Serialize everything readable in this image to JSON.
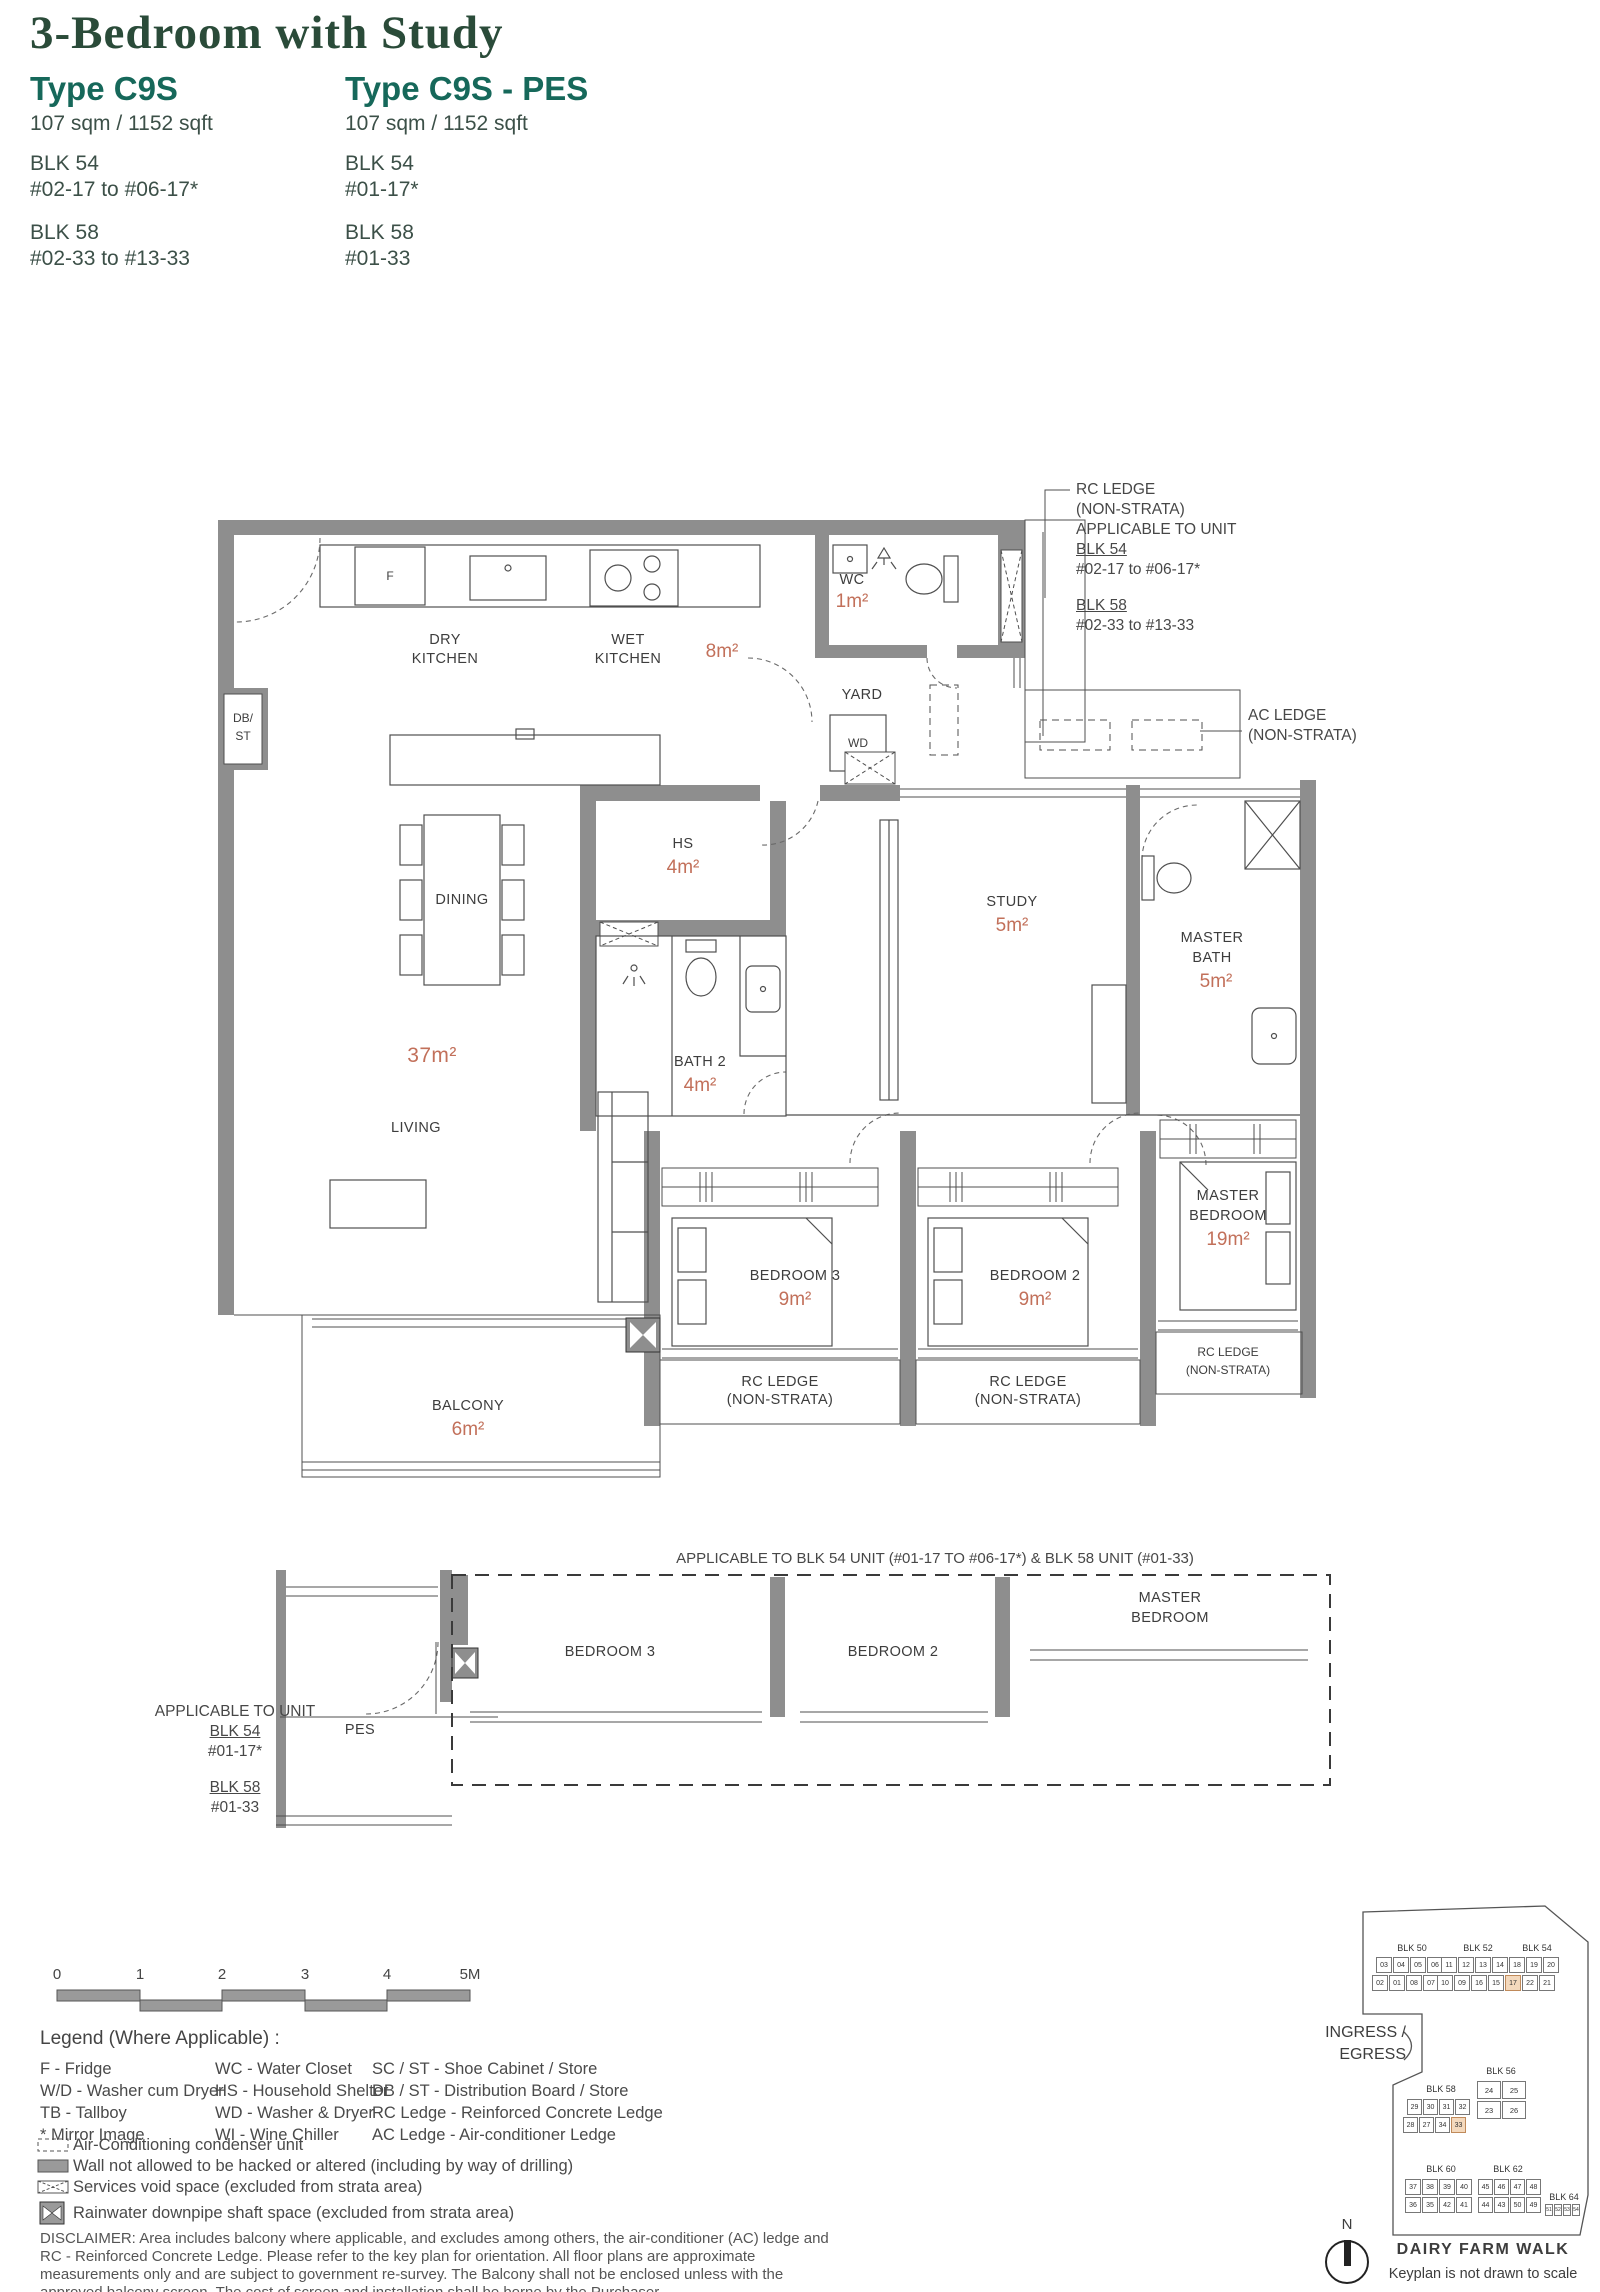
{
  "header": {
    "title": "3-Bedroom with Study",
    "types": [
      {
        "name": "Type C9S",
        "area": "107 sqm / 1152 sqft",
        "blocks": [
          {
            "blk": "BLK 54",
            "units": "#02-17 to #06-17*"
          },
          {
            "blk": "BLK 58",
            "units": "#02-33 to #13-33"
          }
        ]
      },
      {
        "name": "Type C9S - PES",
        "area": "107 sqm / 1152 sqft",
        "blocks": [
          {
            "blk": "BLK 54",
            "units": "#01-17*"
          },
          {
            "blk": "BLK 58",
            "units": "#01-33"
          }
        ]
      }
    ]
  },
  "rooms": {
    "dry": {
      "l1": "DRY",
      "l2": "KITCHEN"
    },
    "wet": {
      "l1": "WET",
      "l2": "KITCHEN",
      "area": "8m²"
    },
    "wc": {
      "l1": "WC",
      "area": "1m²"
    },
    "yard": {
      "l1": "YARD"
    },
    "wd": {
      "l1": "WD"
    },
    "fridge": {
      "l1": "F"
    },
    "dbst": {
      "l1": "DB/",
      "l2": "ST"
    },
    "dining": {
      "l1": "DINING"
    },
    "hs": {
      "l1": "HS",
      "area": "4m²"
    },
    "bath2": {
      "l1": "BATH 2",
      "area": "4m²"
    },
    "study": {
      "l1": "STUDY",
      "area": "5m²"
    },
    "master_bath": {
      "l1": "MASTER",
      "l2": "BATH",
      "area": "5m²"
    },
    "living": {
      "l1": "LIVING",
      "area": "37m²"
    },
    "bedroom3": {
      "l1": "BEDROOM 3",
      "area": "9m²"
    },
    "bedroom2": {
      "l1": "BEDROOM 2",
      "area": "9m²"
    },
    "master_bedroom": {
      "l1": "MASTER",
      "l2": "BEDROOM",
      "area": "19m²"
    },
    "balcony": {
      "l1": "BALCONY",
      "area": "6m²"
    },
    "pes": {
      "l1": "PES"
    }
  },
  "annotations": {
    "rc_top": {
      "l1": "RC LEDGE",
      "l2": "(NON-STRATA)",
      "l3": "APPLICABLE TO UNIT",
      "blk1": "BLK 54",
      "u1": "#02-17 to #06-17*",
      "blk2": "BLK 58",
      "u2": "#02-33 to #13-33"
    },
    "ac": {
      "l1": "AC LEDGE",
      "l2": "(NON-STRATA)"
    },
    "rc": {
      "l1": "RC LEDGE",
      "l2": "(NON-STRATA)"
    },
    "pes_note": {
      "l1": "APPLICABLE TO UNIT",
      "blk1": "BLK 54",
      "u1": "#01-17*",
      "blk2": "BLK 58",
      "u2": "#01-33"
    },
    "ground_note": "APPLICABLE TO BLK 54 UNIT (#01-17 TO #06-17*) & BLK 58 UNIT (#01-33)",
    "ground": {
      "bedroom3": "BEDROOM 3",
      "bedroom2": "BEDROOM 2",
      "master1": "MASTER",
      "master2": "BEDROOM"
    }
  },
  "scalebar": {
    "ticks": [
      "0",
      "1",
      "2",
      "3",
      "4",
      "5M"
    ]
  },
  "legend": {
    "title": "Legend (Where Applicable) :",
    "col1": [
      "F - Fridge",
      "W/D - Washer cum Dryer",
      "TB - Tallboy",
      "* Mirror Image"
    ],
    "col2": [
      "WC - Water Closet",
      "HS - Household Shelter",
      "WD - Washer & Dryer",
      "WI  - Wine Chiller"
    ],
    "col3": [
      "SC / ST - Shoe Cabinet / Store",
      "DB / ST - Distribution Board / Store",
      "RC Ledge - Reinforced Concrete Ledge",
      "AC Ledge - Air-conditioner Ledge"
    ],
    "symbols": [
      "Air-Conditioning condenser unit",
      "Wall not allowed to be hacked or altered (including by way of drilling)",
      "Services void space (excluded from strata area)",
      "Rainwater downpipe shaft space (excluded from strata area)"
    ]
  },
  "disclaimer": "DISCLAIMER: Area includes balcony where applicable, and excludes among others, the air-conditioner (AC) ledge and RC - Reinforced Concrete Ledge. Please refer to the key plan for orientation. All floor plans are approximate measurements only and are subject to government re-survey. The Balcony shall not be enclosed unless with the approved balcony screen. The cost of screen and installation shall be borne by the Purchaser.",
  "keyplan": {
    "blocks": [
      {
        "id": "blk50",
        "name": "BLK 50",
        "row1": [
          "03",
          "04",
          "05",
          "06"
        ],
        "row2": [
          "02",
          "01",
          "08",
          "07"
        ],
        "highlight": []
      },
      {
        "id": "blk52",
        "name": "BLK 52",
        "row1": [
          "11",
          "12",
          "13",
          "14"
        ],
        "row2": [
          "10",
          "09",
          "16",
          "15"
        ],
        "highlight": []
      },
      {
        "id": "blk54",
        "name": "BLK 54",
        "row1": [
          "18",
          "19",
          "20"
        ],
        "row2": [
          "17",
          "22",
          "21"
        ],
        "highlight": [
          "17"
        ]
      },
      {
        "id": "blk56",
        "name": "BLK 56",
        "row1": [
          "24",
          "25"
        ],
        "row2": [
          "23",
          "26"
        ],
        "highlight": []
      },
      {
        "id": "blk58",
        "name": "BLK 58",
        "row1": [
          "29",
          "30",
          "31",
          "32"
        ],
        "row2": [
          "28",
          "27",
          "34",
          "33"
        ],
        "highlight": [
          "33"
        ]
      },
      {
        "id": "blk60",
        "name": "BLK 60",
        "row1": [
          "37",
          "38",
          "39",
          "40"
        ],
        "row2": [
          "36",
          "35",
          "42",
          "41"
        ],
        "highlight": []
      },
      {
        "id": "blk62",
        "name": "BLK 62",
        "row1": [
          "45",
          "46",
          "47",
          "48"
        ],
        "row2": [
          "44",
          "43",
          "50",
          "49"
        ],
        "highlight": []
      },
      {
        "id": "blk64",
        "name": "BLK 64",
        "row1": [
          "51",
          "52",
          "53",
          "54"
        ],
        "row2": [],
        "highlight": []
      }
    ],
    "ingress1": "INGRESS /",
    "ingress2": "EGRESS",
    "street": "DAIRY FARM WALK",
    "note": "Keyplan is not drawn to scale",
    "compass": "N",
    "highlight_color": "#f4d9bd"
  }
}
